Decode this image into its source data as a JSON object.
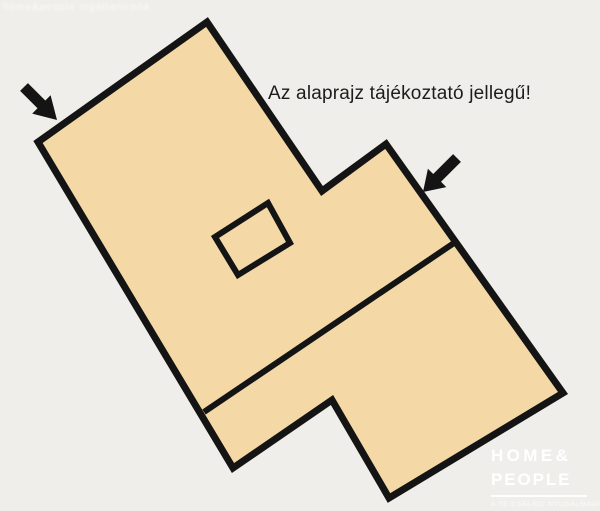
{
  "colors": {
    "background": "#efeeea",
    "plan_fill": "#f4d9a7",
    "plan_outline": "#141414",
    "heading_text": "#1c1c1c",
    "logo_text": "#ffffff"
  },
  "watermark": {
    "text": "home&people ingatlaniroda"
  },
  "heading": {
    "text": "Az alaprajz tájékoztató jellegű!"
  },
  "floorplan": {
    "outline_points": "207,22 322,191 386,144 563,393 389,498 332,400 233,468 38,142",
    "inner_square_points": "268,203 290,243 238,275 215,237",
    "interior_wall_points": "204,412 454,243",
    "arrow_left_points": "57,120 50.6,95.2 45.3,100.5 27.9,83.1 20.1,90.9 37.5,108.3 32.2,113.6",
    "arrow_right_points": "423,192 446.3,187.1 441,181.8 460.9,161.9 453.1,154.1 433.2,174 427.9,168.7"
  },
  "logo": {
    "line1": "HOME&",
    "line2": "PEOPLE",
    "tagline": "A TE CSALÁDI NYUGALMADHOZ"
  }
}
